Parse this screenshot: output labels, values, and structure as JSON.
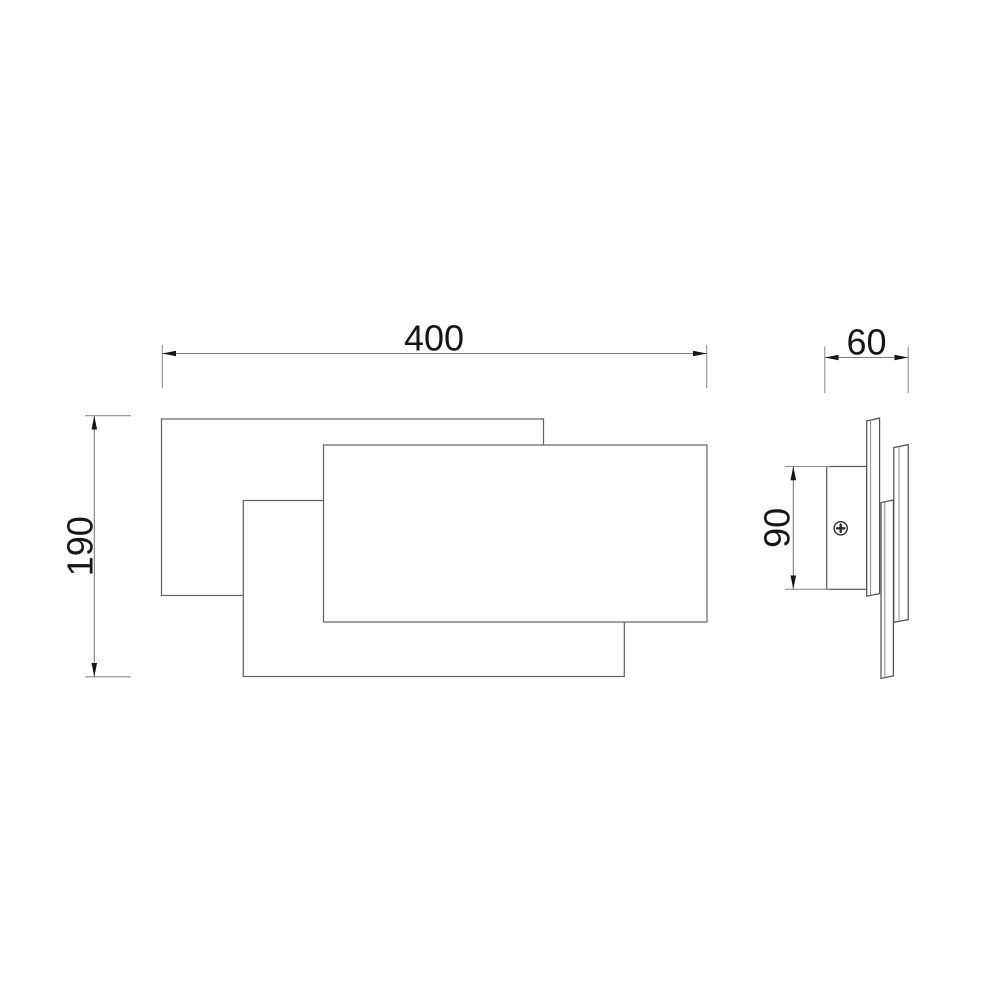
{
  "drawing": {
    "kind": "technical dimension drawing",
    "dimensions": {
      "overall_width": {
        "value": "400"
      },
      "overall_height": {
        "value": "190"
      },
      "overall_depth": {
        "value": "60"
      },
      "bracket_height": {
        "value": "90"
      }
    },
    "colors": {
      "background": "#ffffff",
      "panel_outline": "#606060",
      "side_outline": "#4d4d4d",
      "dimension_line": "#7d7d7d",
      "extension_line": "#8f8f8f",
      "arrow_and_text": "#151515",
      "screw": "#2e2e2e"
    }
  }
}
